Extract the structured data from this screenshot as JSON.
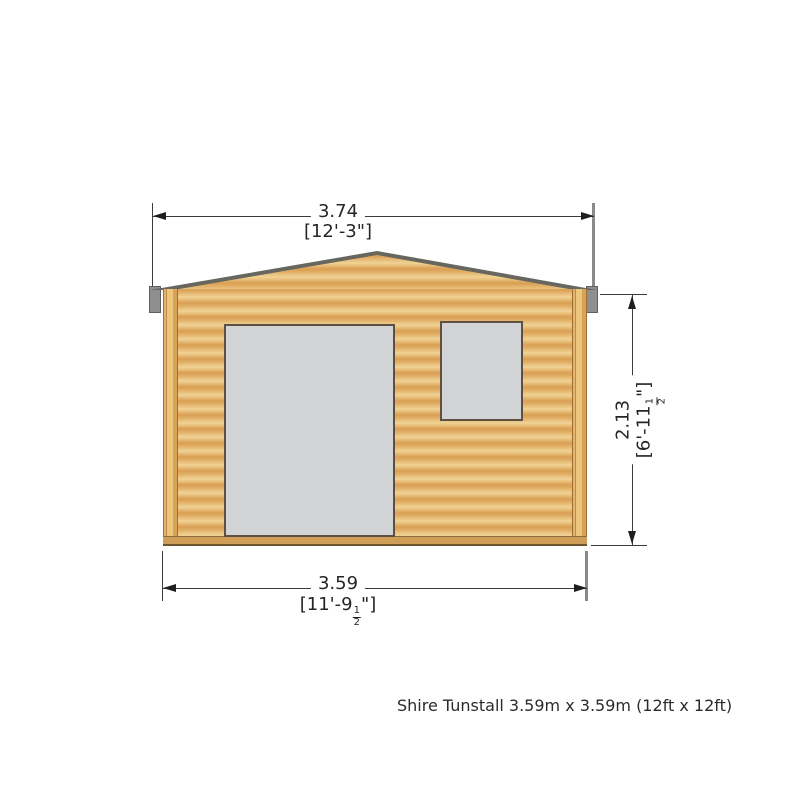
{
  "drawing_label": "Shire Tunstall log cabin front elevation",
  "caption": "Shire Tunstall 3.59m x 3.59m (12ft x 12ft)",
  "dimensions": {
    "top_width": {
      "metric_m": "3.74",
      "imperial": "[12'-3\"]"
    },
    "bottom_width": {
      "metric_m": "3.59",
      "imperial_pre": "[11'-9",
      "fraction_numerator": "1",
      "fraction_denominator": "2",
      "imperial_post": "\"]"
    },
    "right_height": {
      "metric_m": "2.13",
      "imperial_pre": "[6'-11",
      "fraction_numerator": "1",
      "fraction_denominator": "2",
      "imperial_post": "\"]"
    }
  },
  "colors": {
    "wood_band_dark": "#d99e54",
    "wood_band_light": "#efd395",
    "roof_fascia": "#67675f",
    "eave_cap": "#8f8f8f",
    "opening_fill": "#d3d4d6",
    "opening_border": "#5c5144",
    "dimension_line": "#3c3c3c"
  }
}
